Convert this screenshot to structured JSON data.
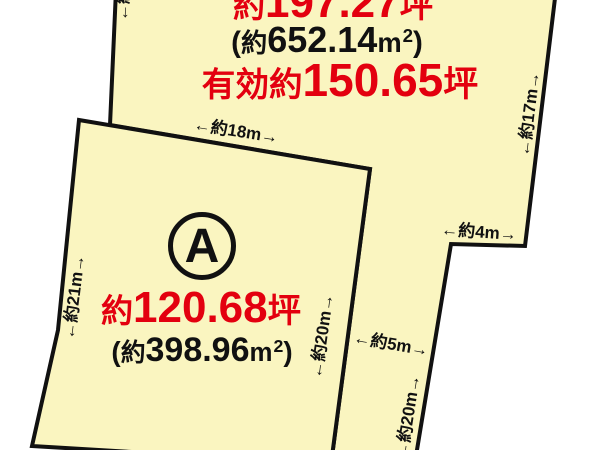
{
  "diagram": {
    "upper_parcel": {
      "area_tsubo": {
        "prefix": "約",
        "value": "197.27",
        "unit": "坪"
      },
      "area_sqm": {
        "open": "(",
        "prefix": "約",
        "value": "652.14",
        "unit": "m",
        "exponent": "2",
        "close": ")"
      },
      "effective": {
        "prefix": "有効約",
        "value": "150.65",
        "unit": "坪"
      }
    },
    "parcel_a": {
      "badge": "A",
      "area_tsubo": {
        "prefix": "約",
        "value": "120.68",
        "unit": "坪"
      },
      "area_sqm": {
        "open": "(",
        "prefix": "約",
        "value": "398.96",
        "unit": "m",
        "exponent": "2",
        "close": ")"
      }
    },
    "dimensions": {
      "top_edge_18m": "←約18m→",
      "right_edge_17m": "←約17m→",
      "step_4m": "←約4m→",
      "strip_width_5m": "←約5m→",
      "left_edge_21m": "←約21m→",
      "parcel_a_right_20m": "←約20m→",
      "strip_right_20m": "←約20m→",
      "top_left_partial": "←約"
    },
    "colors": {
      "land_fill": "#faf5c0",
      "outline": "#111111",
      "accent_red": "#e3000f",
      "text_black": "#111111"
    }
  }
}
